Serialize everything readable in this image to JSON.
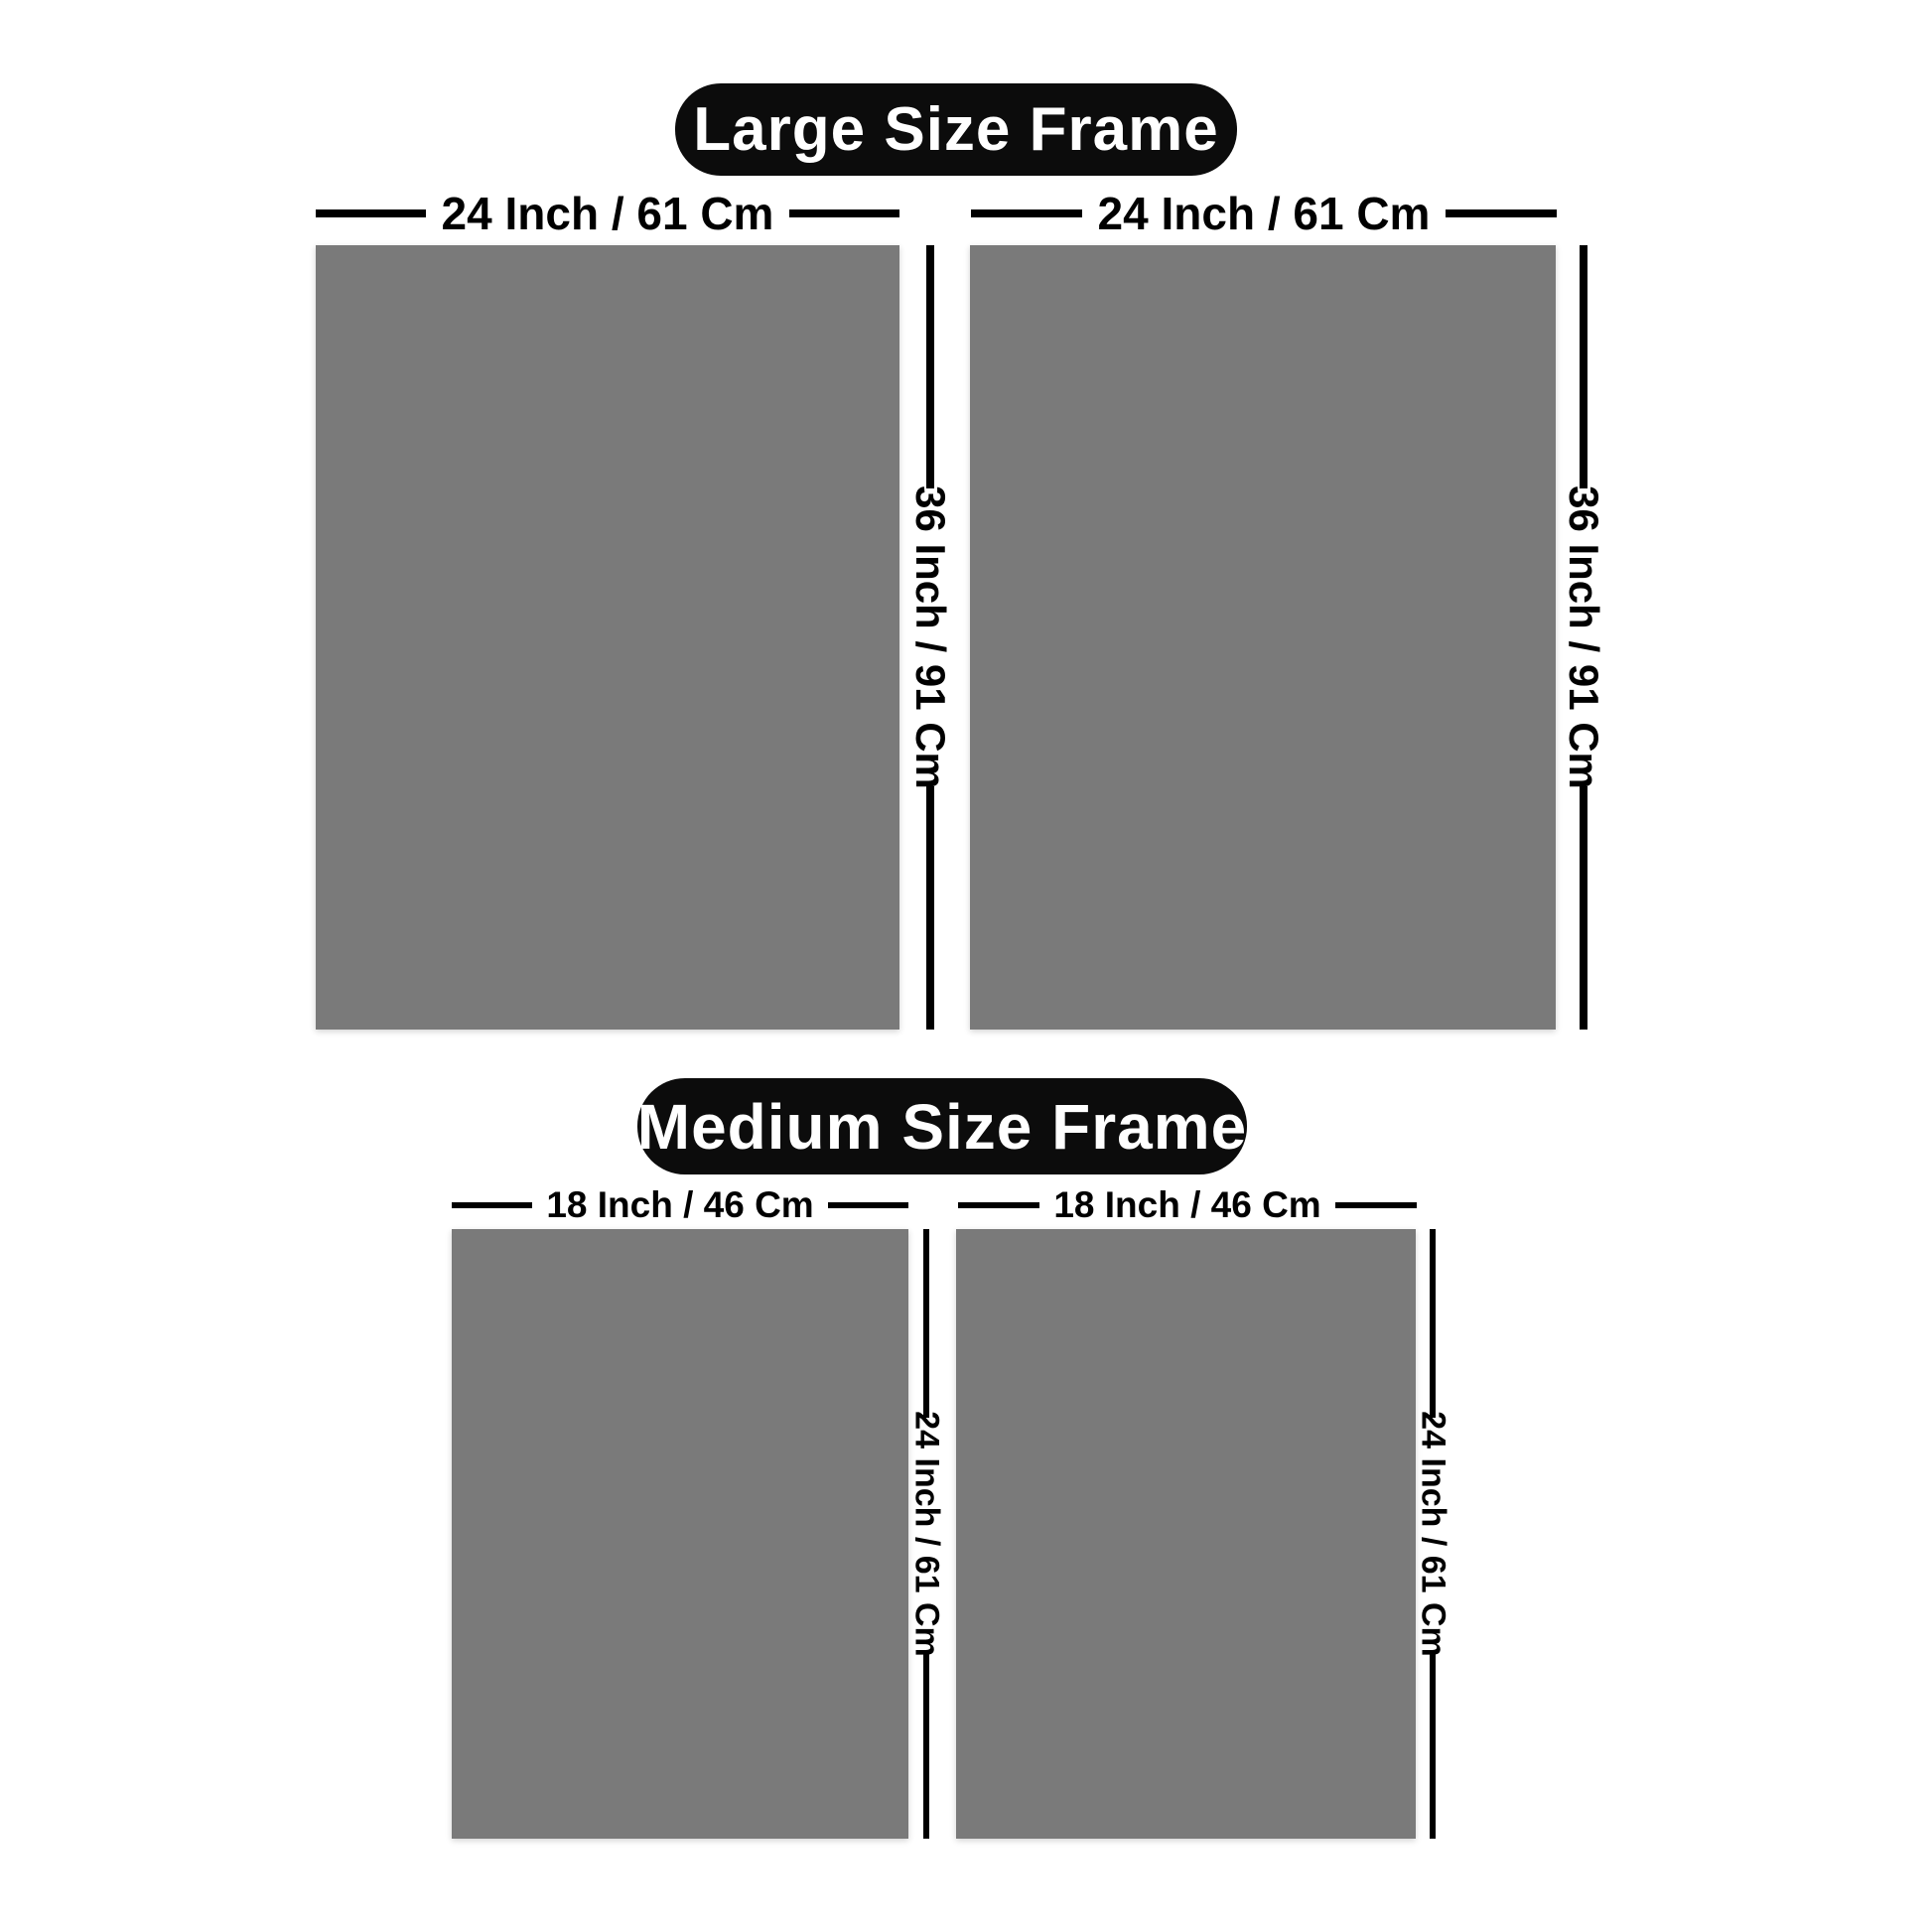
{
  "sections": [
    {
      "title": "Large Size Frame",
      "width_label": "24 Inch / 61 Cm",
      "height_label": "36 Inch / 91 Cm"
    },
    {
      "title": "Medium Size Frame",
      "width_label": "18 Inch / 46 Cm",
      "height_label": "24 Inch / 61 Cm"
    }
  ],
  "colors": {
    "background": "#ffffff",
    "frame_fill": "#7a7a7a",
    "pill_background": "#0c0c0c",
    "pill_text": "#ffffff",
    "dimension_line": "#000000"
  }
}
